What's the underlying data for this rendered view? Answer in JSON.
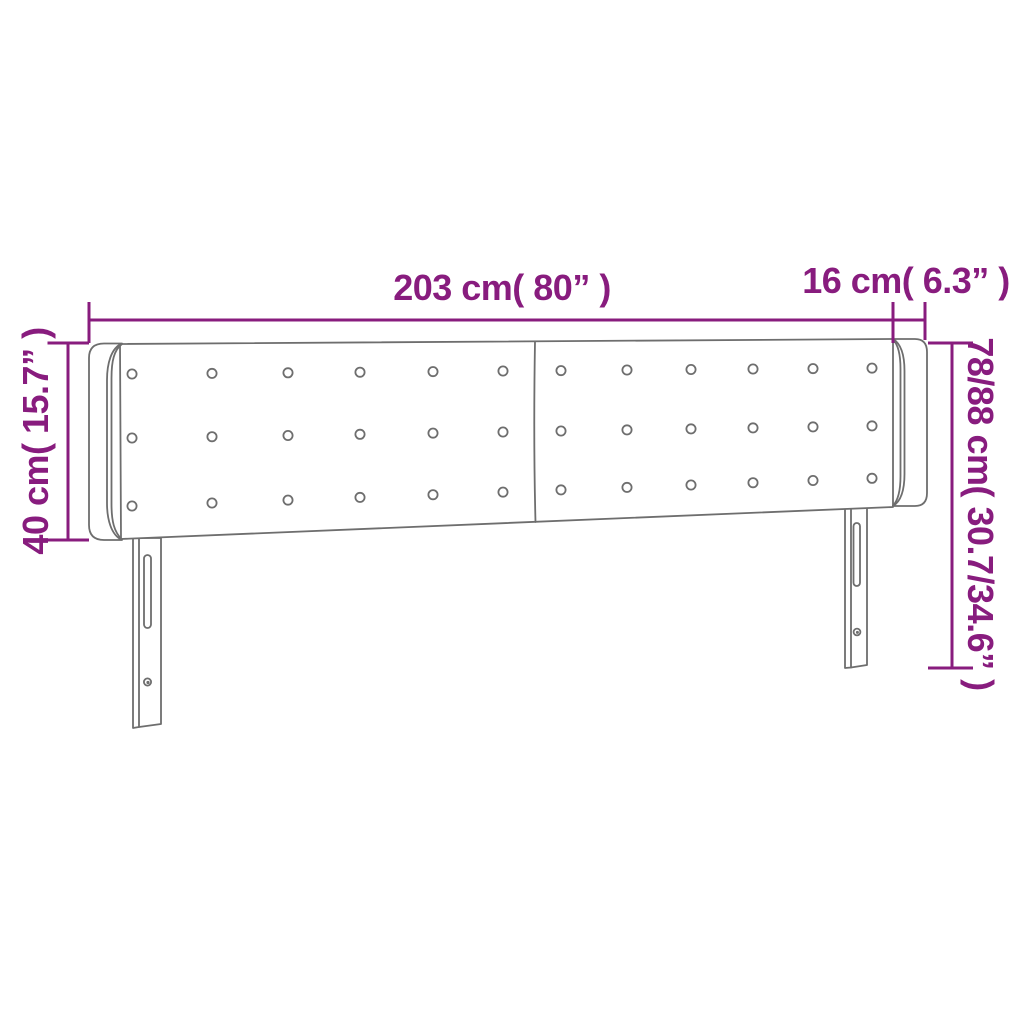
{
  "diagram": {
    "type": "product-dimension-diagram",
    "subject": "tufted headboard with side wings and two slotted legs",
    "background_color": "#ffffff",
    "dimension_color": "#881c7e",
    "outline_color": "#6e6e6e",
    "labels": {
      "total_width": "203 cm( 80” )",
      "wing_depth": "16 cm( 6.3” )",
      "headboard_height": "40 cm( 15.7” )",
      "total_height": "78/88 cm( 30.7/34.6” )"
    },
    "tufting": {
      "rows": 3,
      "columns": 12
    }
  }
}
